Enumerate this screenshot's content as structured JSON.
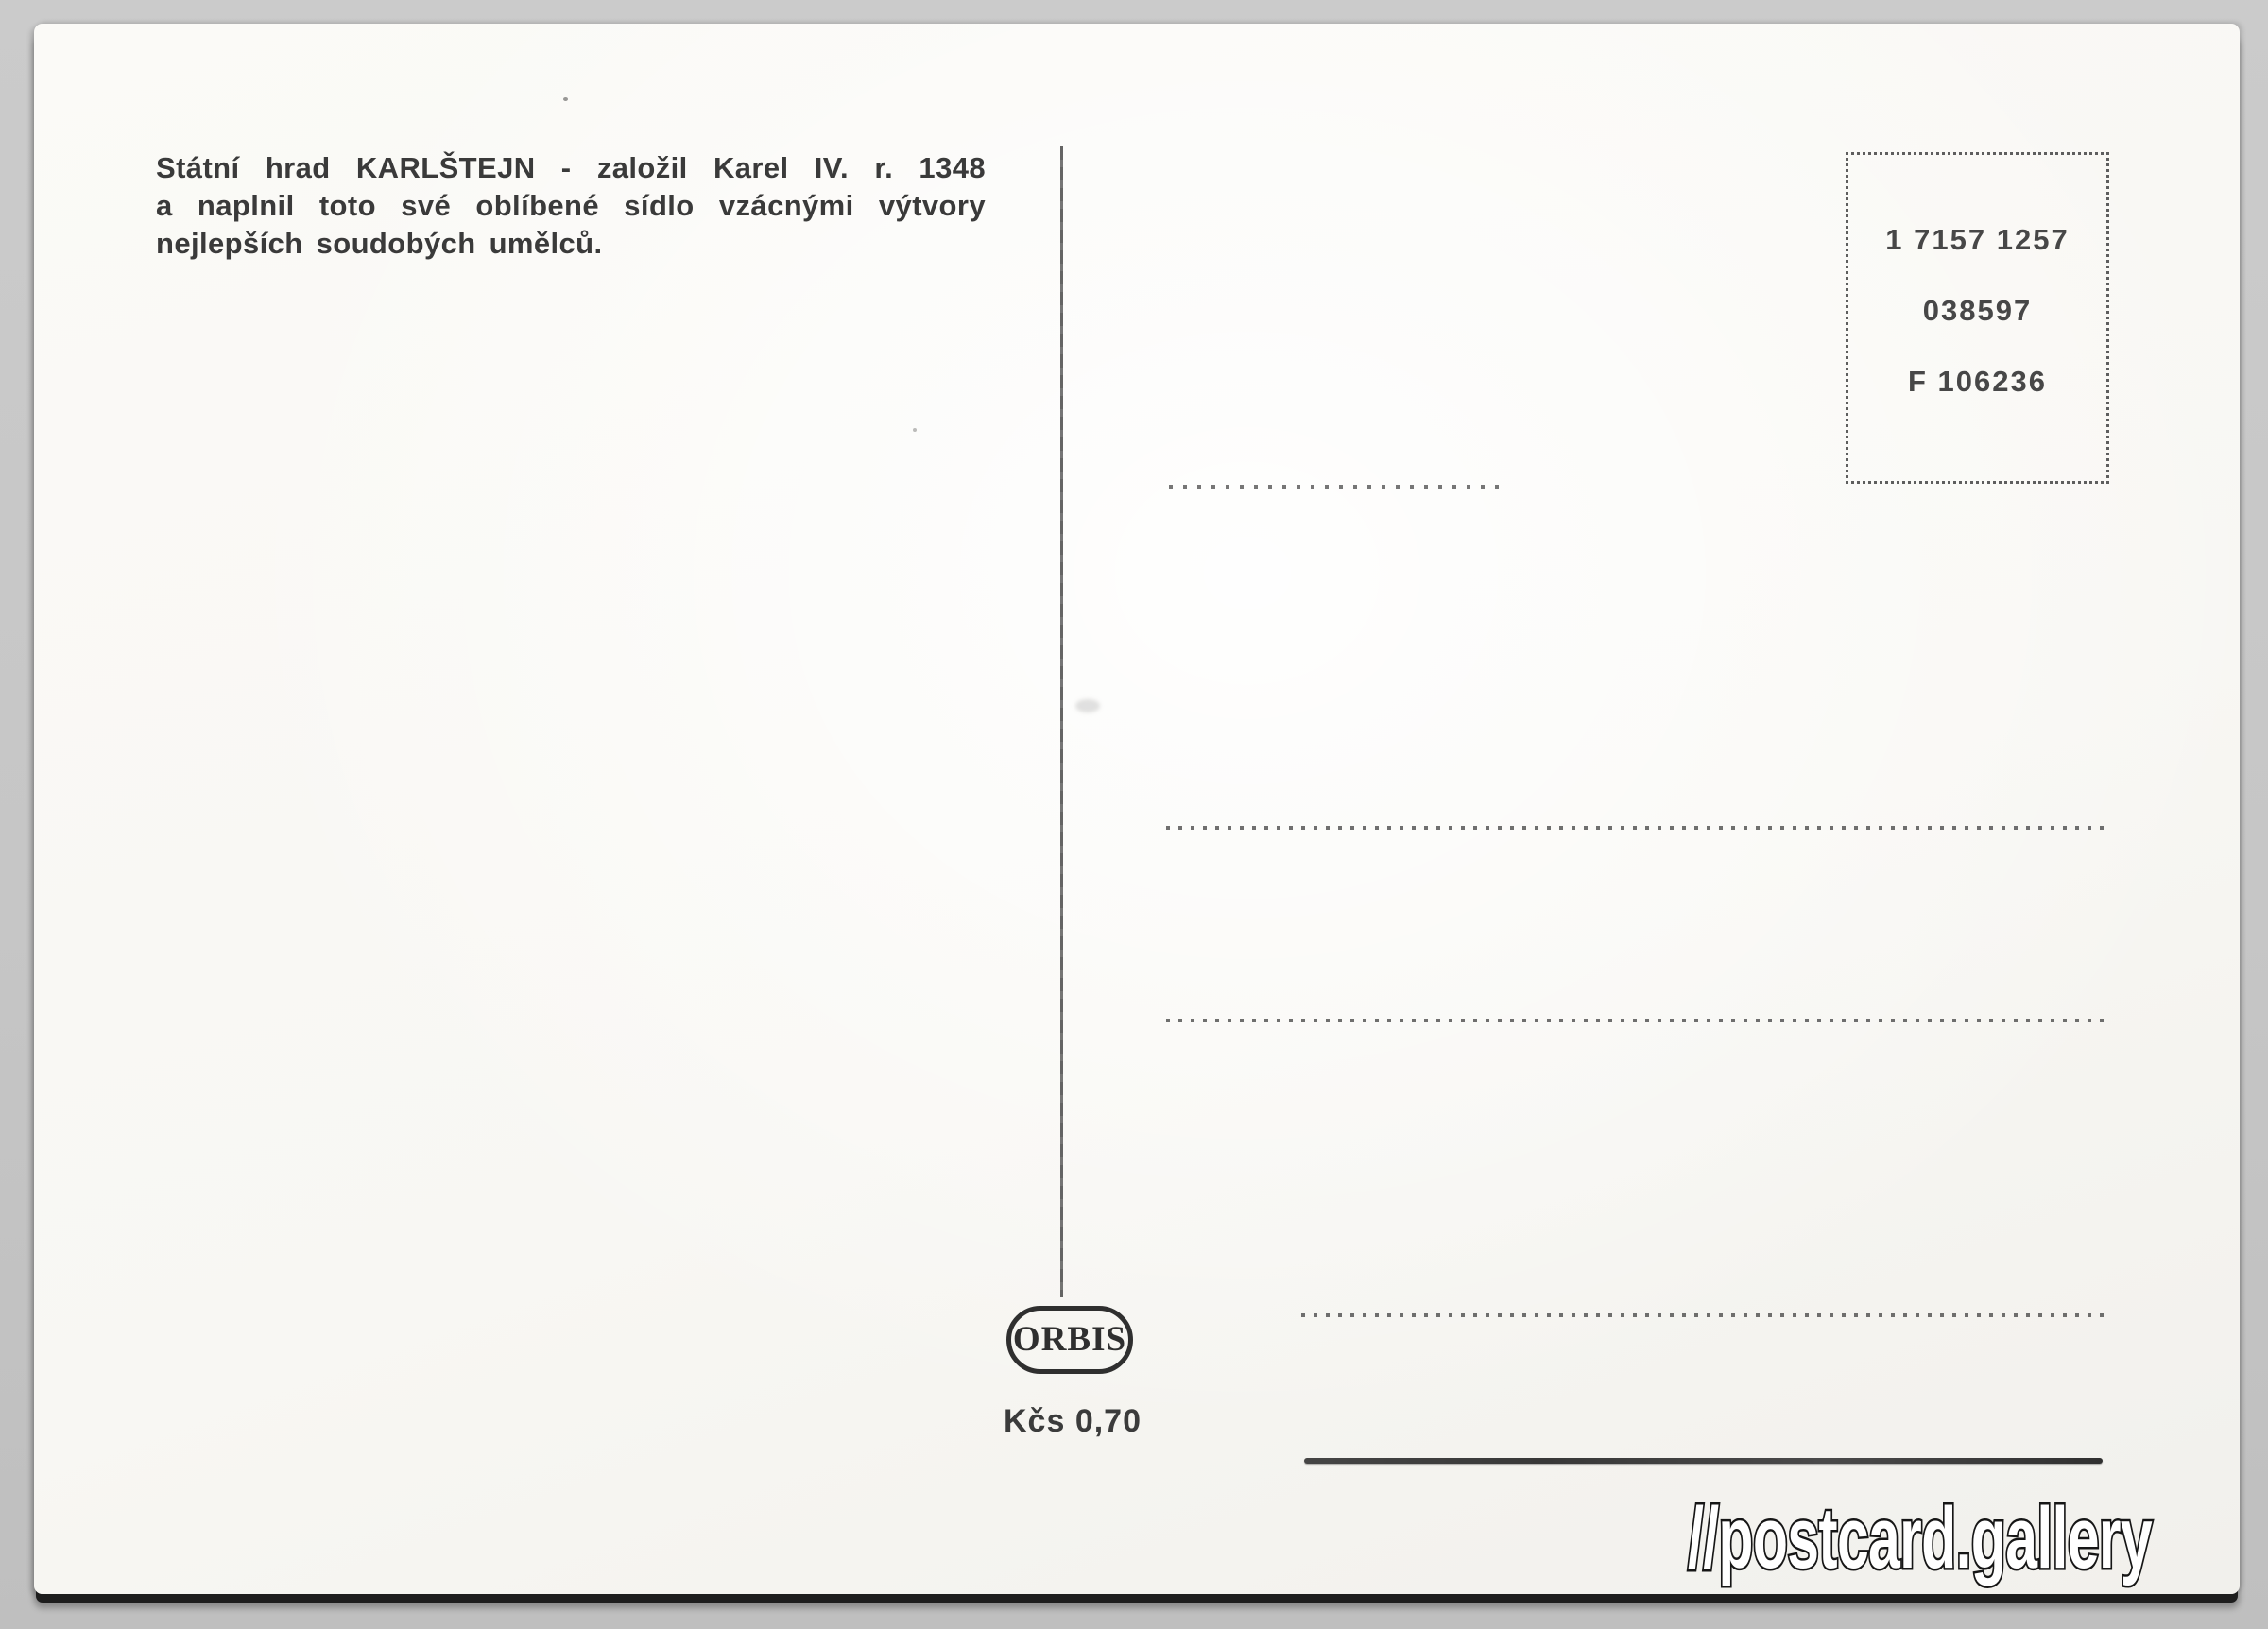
{
  "card": {
    "caption": {
      "lines": [
        "Státní hrad KARLŠTEJN - založil Karel IV. r. 1348",
        "a naplnil toto své oblíbené sídlo vzácnými výtvory",
        "nejlepších soudobých umělců."
      ]
    },
    "stamp_box": {
      "codes": [
        "1 7157 1257",
        "038597",
        "F 106236"
      ]
    },
    "publisher": {
      "logo": "ORBIS",
      "price": "Kčs 0,70"
    },
    "colors": {
      "paper": "#fbfaf7",
      "ink": "#3a3a3a",
      "line": "#4c4c4c",
      "background": "#c6c6c6"
    }
  },
  "watermark": {
    "text": "//postcard.gallery"
  }
}
